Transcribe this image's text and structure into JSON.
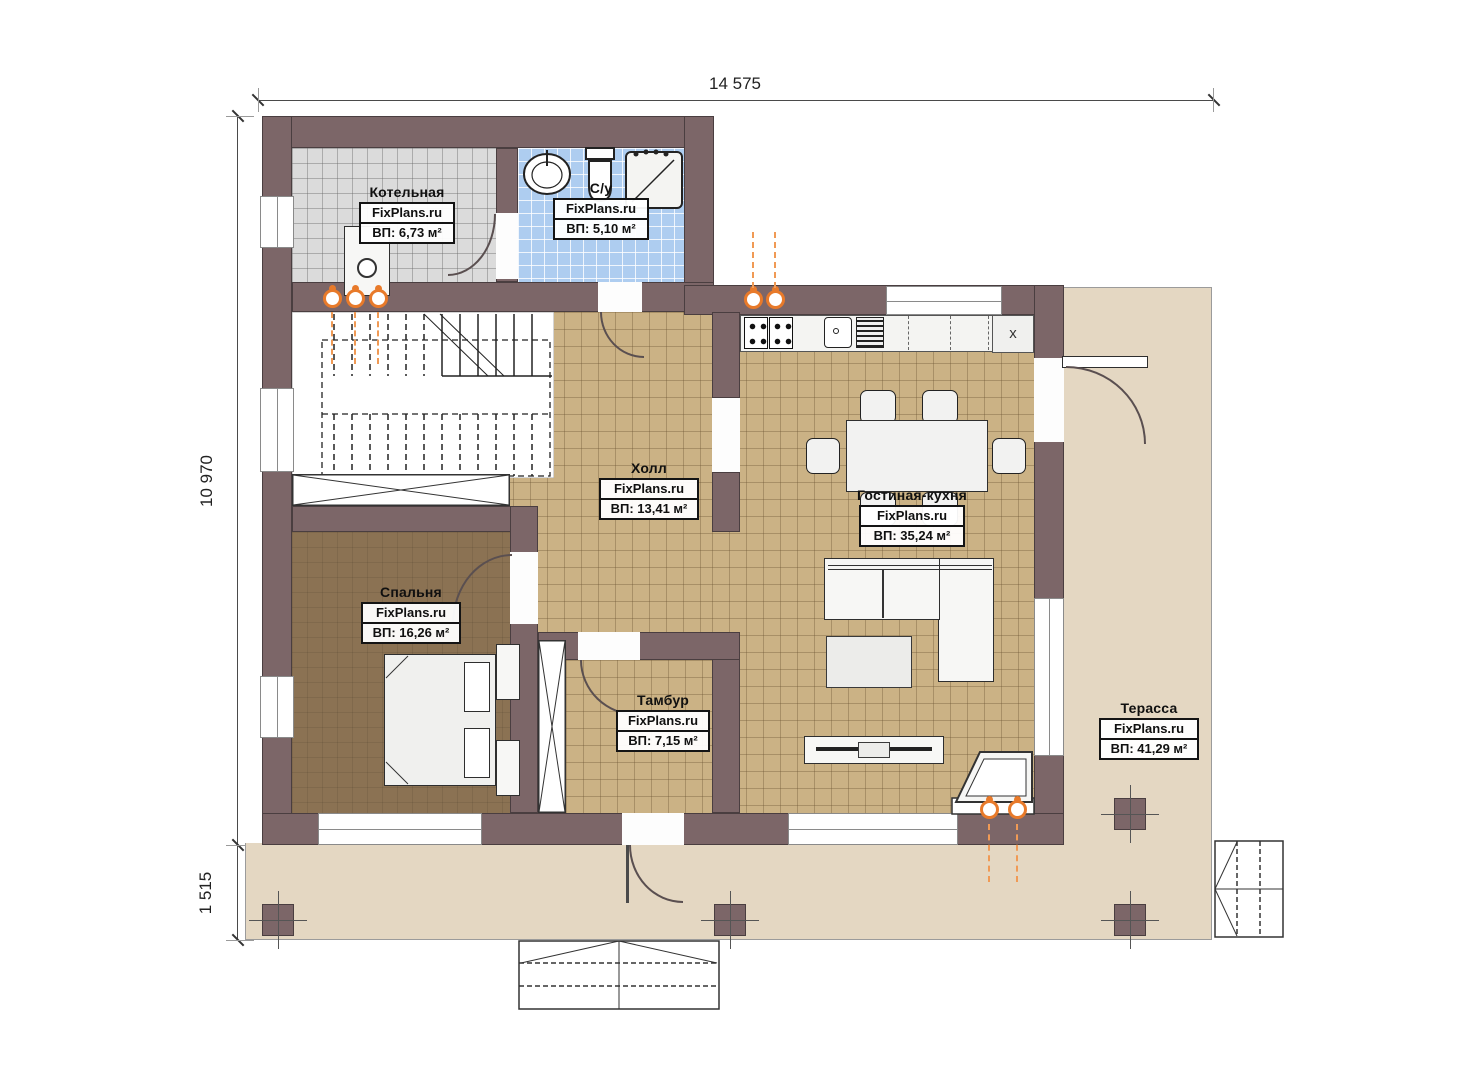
{
  "plan": {
    "dimensions": {
      "width_total": "14 575",
      "height_main": "10 970",
      "height_porch": "1 515"
    },
    "rooms": [
      {
        "name": "Котельная",
        "brand": "FixPlans.ru",
        "area": "ВП: 6,73 м²"
      },
      {
        "name": "С/у",
        "brand": "FixPlans.ru",
        "area": "ВП: 5,10 м²"
      },
      {
        "name": "Холл",
        "brand": "FixPlans.ru",
        "area": "ВП: 13,41 м²"
      },
      {
        "name": "Гостиная-кухня",
        "brand": "FixPlans.ru",
        "area": "ВП: 35,24 м²"
      },
      {
        "name": "Спальня",
        "brand": "FixPlans.ru",
        "area": "ВП: 16,26 м²"
      },
      {
        "name": "Тамбур",
        "brand": "FixPlans.ru",
        "area": "ВП: 7,15 м²"
      },
      {
        "name": "Терасса",
        "brand": "FixPlans.ru",
        "area": "ВП: 41,29 м²"
      }
    ],
    "kitchen": {
      "cabinet_mark": "x"
    },
    "colors": {
      "wall": "#7c6668",
      "floor_wood": "#cbb285",
      "floor_bedroom": "#8b7253",
      "floor_boiler": "#dbdbdb",
      "floor_bath": "#aecdf0",
      "terrace": "#e4d7c2",
      "riser_orange": "#e87a2a"
    }
  }
}
